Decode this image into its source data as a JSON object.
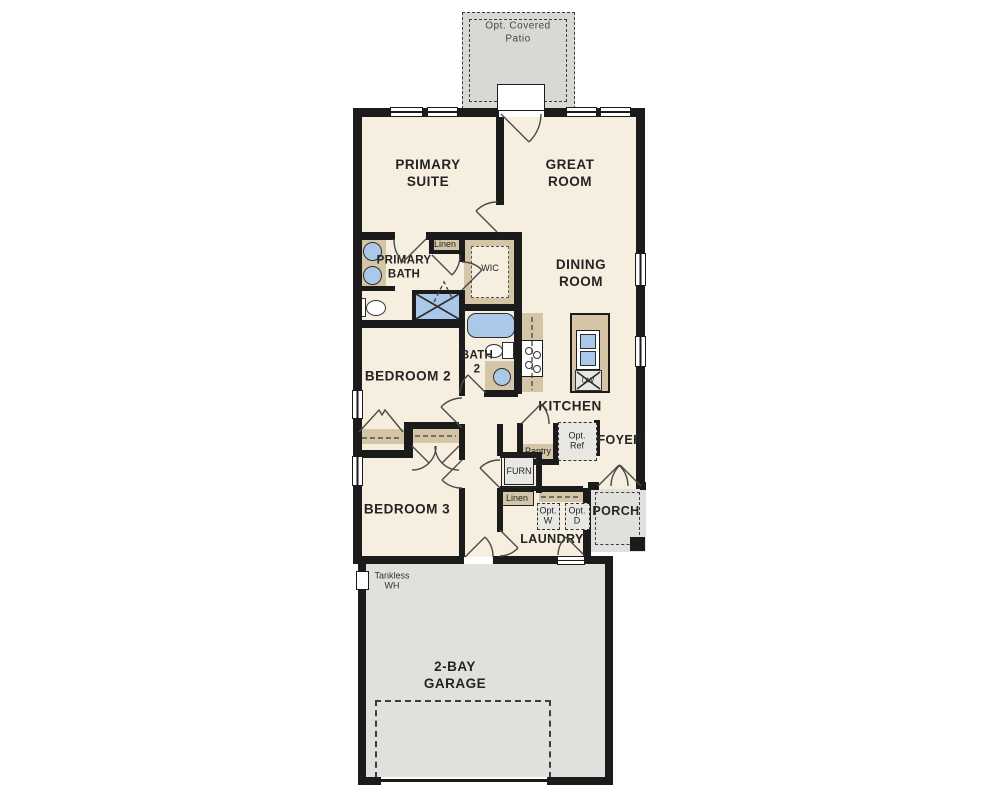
{
  "floor_plan": {
    "labels": {
      "patio": "Opt. Covered\nPatio",
      "primary_suite": "PRIMARY\nSUITE",
      "great_room": "GREAT\nROOM",
      "primary_bath": "PRIMARY\nBATH",
      "linen_upper": "Linen",
      "wic": "WIC",
      "dining_room": "DINING\nROOM",
      "bedroom2": "BEDROOM 2",
      "bath2": "BATH\n2",
      "kitchen": "KITCHEN",
      "pantry": "Pantry",
      "opt_ref": "Opt.\nRef",
      "foyer": "FOYER",
      "furnace": "FURN",
      "linen_lower": "Linen",
      "opt_washer": "Opt.\nW",
      "opt_dryer": "Opt.\nD",
      "porch": "PORCH",
      "laundry": "LAUNDRY",
      "bedroom3": "BEDROOM 3",
      "tankless_wh": "Tankless\nWH",
      "garage": "2-BAY\nGARAGE",
      "dishwasher": "DW"
    },
    "colors": {
      "wall": "#1b1b1b",
      "room": "#f6eede",
      "tan": "#d3c5a6",
      "blue": "#aac9e8",
      "gray1": "#d9d8d5",
      "gray2": "#e1e0dd",
      "optbox": "#e8e7e4",
      "line": "#4a4a4a"
    }
  }
}
